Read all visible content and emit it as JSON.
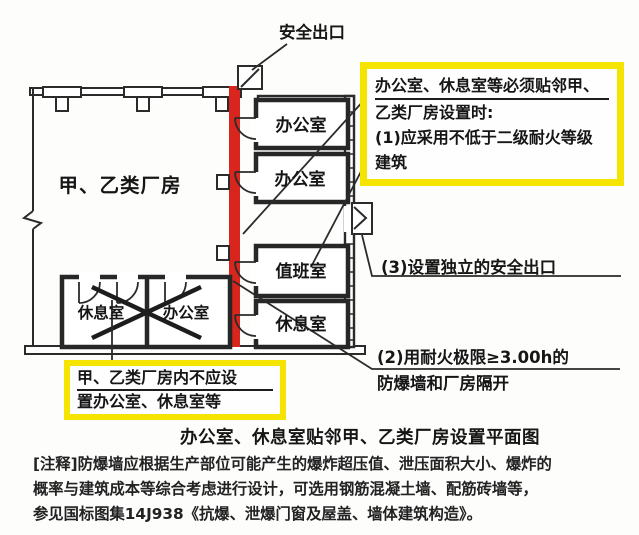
{
  "colors": {
    "highlight_yellow": "#f5e300",
    "firewall_red": "#d8261e",
    "line_dark": "#2b2b2b"
  },
  "plan": {
    "safety_exit_label": "安全出口",
    "factory_label": "甲、乙类厂房",
    "annex_rooms": [
      "办公室",
      "办公室",
      "值班室",
      "休息室"
    ],
    "prohibited_rooms": [
      "休息室",
      "办公室"
    ]
  },
  "annotations": {
    "adjacency_requirement": {
      "line1": "办公室、休息室等必须贴邻甲、",
      "line2": "乙类厂房设置时:",
      "line3": "(1)应采用不低于二级耐火等级",
      "line4": "建筑"
    },
    "independent_exit": "(3)设置独立的安全出口",
    "firewall": {
      "line1": "(2)用耐火极限≥3.00h的",
      "line2": "防爆墙和厂房隔开"
    },
    "prohibition": {
      "line1": "甲、乙类厂房内不应设",
      "line2": "置办公室、休息室等"
    }
  },
  "caption": "办公室、休息室贴邻甲、乙类厂房设置平面图",
  "notes": [
    "[注释]防爆墙应根据生产部位可能产生的爆炸超压值、泄压面积大小、爆炸的",
    "概率与建筑成本等综合考虑进行设计，可选用钢筋混凝土墙、配筋砖墙等，",
    "参见国标图集14J938《抗爆、泄爆门窗及屋盖、墙体建筑构造》。"
  ]
}
